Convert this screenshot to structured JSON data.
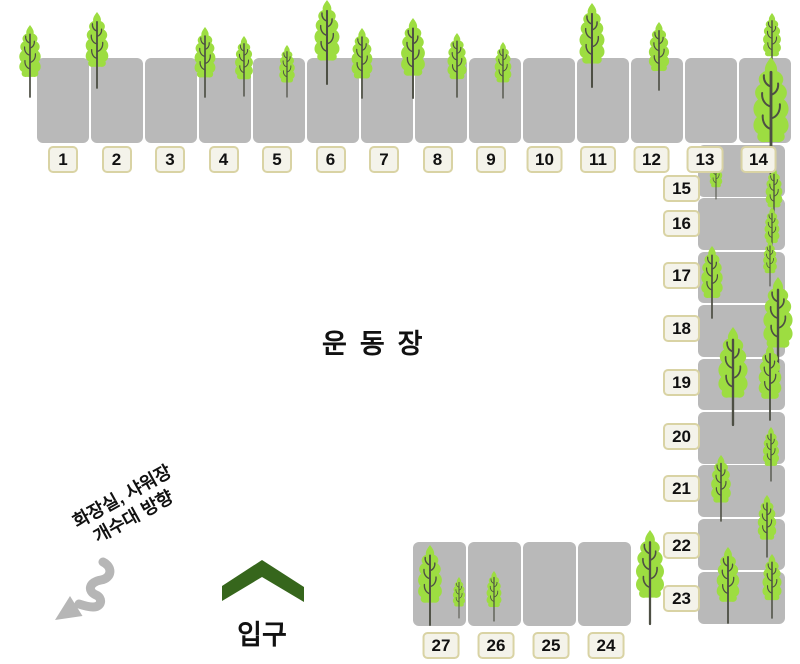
{
  "field": {
    "label": "운동장"
  },
  "entrance": {
    "label": "입구"
  },
  "facilities_direction": {
    "line1": "화장실, 샤워장",
    "line2": "개수대 방향"
  },
  "sites": {
    "top_row": [
      "1",
      "2",
      "3",
      "4",
      "5",
      "6",
      "7",
      "8",
      "9",
      "10",
      "11",
      "12",
      "13",
      "14"
    ],
    "right_column": [
      {
        "number": "15",
        "top": 175
      },
      {
        "number": "16",
        "top": 210
      },
      {
        "number": "17",
        "top": 262
      },
      {
        "number": "18",
        "top": 315
      },
      {
        "number": "19",
        "top": 369
      },
      {
        "number": "20",
        "top": 423
      },
      {
        "number": "21",
        "top": 475
      },
      {
        "number": "22",
        "top": 532
      },
      {
        "number": "23",
        "top": 585
      }
    ],
    "bottom_row": [
      "27",
      "26",
      "25",
      "24"
    ]
  },
  "colors": {
    "site_block": "#b9b9b9",
    "label_background": "#f4f3ea",
    "label_border": "#d9d3a4",
    "tree_foliage": "#9ddd41",
    "tree_trunk": "#4d4f44",
    "entrance_arrow": "#36661c",
    "direction_arrow": "#b6b6b6",
    "text": "#111111"
  },
  "icons": {
    "tree": "tree-icon",
    "entrance_arrow": "chevron-up-icon",
    "direction_arrow": "squiggle-arrow-icon"
  },
  "trees": [
    {
      "x": 30,
      "y": 25,
      "h": 72
    },
    {
      "x": 97,
      "y": 12,
      "h": 76
    },
    {
      "x": 205,
      "y": 27,
      "h": 70
    },
    {
      "x": 244,
      "y": 36,
      "h": 60
    },
    {
      "x": 287,
      "y": 45,
      "h": 52
    },
    {
      "x": 327,
      "y": 0,
      "h": 84
    },
    {
      "x": 362,
      "y": 28,
      "h": 70
    },
    {
      "x": 413,
      "y": 18,
      "h": 80
    },
    {
      "x": 457,
      "y": 33,
      "h": 64
    },
    {
      "x": 503,
      "y": 42,
      "h": 56
    },
    {
      "x": 592,
      "y": 3,
      "h": 84
    },
    {
      "x": 659,
      "y": 22,
      "h": 68
    },
    {
      "x": 772,
      "y": 13,
      "h": 60
    },
    {
      "x": 771,
      "y": 57,
      "h": 118
    },
    {
      "x": 716,
      "y": 157,
      "h": 42
    },
    {
      "x": 774,
      "y": 167,
      "h": 56
    },
    {
      "x": 772,
      "y": 207,
      "h": 50
    },
    {
      "x": 770,
      "y": 240,
      "h": 46
    },
    {
      "x": 712,
      "y": 246,
      "h": 72
    },
    {
      "x": 778,
      "y": 277,
      "h": 98
    },
    {
      "x": 733,
      "y": 327,
      "h": 98
    },
    {
      "x": 770,
      "y": 344,
      "h": 76
    },
    {
      "x": 771,
      "y": 427,
      "h": 54
    },
    {
      "x": 721,
      "y": 455,
      "h": 66
    },
    {
      "x": 767,
      "y": 495,
      "h": 62
    },
    {
      "x": 650,
      "y": 530,
      "h": 94
    },
    {
      "x": 728,
      "y": 547,
      "h": 76
    },
    {
      "x": 772,
      "y": 554,
      "h": 64
    },
    {
      "x": 430,
      "y": 545,
      "h": 80
    },
    {
      "x": 459,
      "y": 577,
      "h": 41
    },
    {
      "x": 494,
      "y": 571,
      "h": 50
    }
  ]
}
